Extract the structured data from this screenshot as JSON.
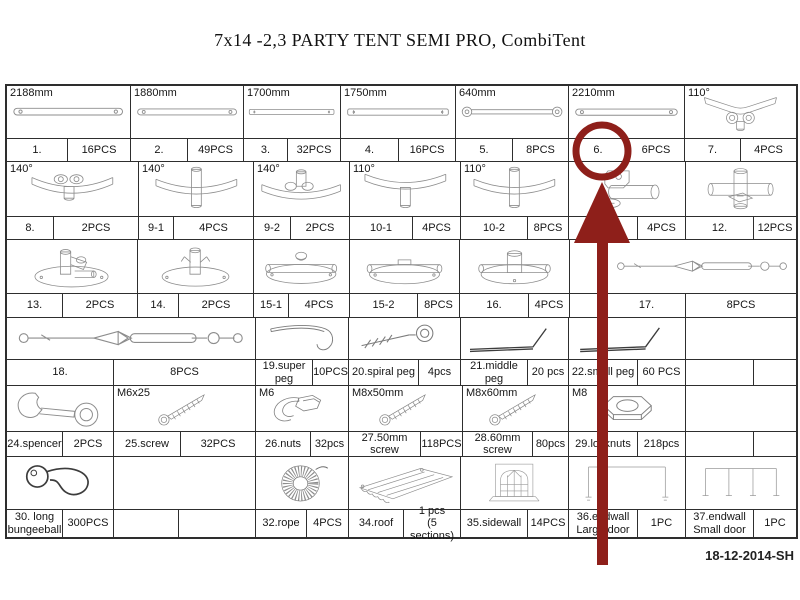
{
  "title": "7x14 -2,3 PARTY TENT SEMI PRO, CombiTent",
  "date_code": "18-12-2014-SH",
  "annotation": {
    "color": "#8e1f1a",
    "circled_part": "6.",
    "shape": "circle-around-part-6-with-arrow-from-below"
  },
  "table": {
    "groups": [
      {
        "illus_h": 53,
        "label_h": 23,
        "cells": [
          {
            "caption": "2188mm",
            "icon": "pole-icon",
            "part": "1.",
            "qty": "16PCS",
            "w": 124,
            "lw": 61
          },
          {
            "caption": "1880mm",
            "icon": "pole-icon",
            "part": "2.",
            "qty": "49PCS",
            "w": 113,
            "lw": 57
          },
          {
            "caption": "1700mm",
            "icon": "pole-flat-icon",
            "part": "3.",
            "qty": "32PCS",
            "w": 97,
            "lw": 44
          },
          {
            "caption": "1750mm",
            "icon": "pole-flat-icon",
            "part": "4.",
            "qty": "16PCS",
            "w": 115,
            "lw": 58
          },
          {
            "caption": "640mm",
            "icon": "strut-icon",
            "part": "5.",
            "qty": "8PCS",
            "w": 113,
            "lw": 57
          },
          {
            "caption": "2210mm",
            "icon": "pole-icon",
            "part": "6.",
            "qty": "6PCS",
            "w": 116,
            "lw": 59
          },
          {
            "caption": "110°",
            "icon": "corner-y-icon",
            "part": "7.",
            "qty": "4PCS",
            "w": 111,
            "lw": 56
          }
        ]
      },
      {
        "illus_h": 55,
        "label_h": 23,
        "cells": [
          {
            "caption": "140°",
            "icon": "corner-knobs-icon",
            "part": "8.",
            "qty": "2PCS",
            "w": 132,
            "lw": 47
          },
          {
            "caption": "140°",
            "icon": "corner-through-icon",
            "part": "9-1",
            "qty": "4PCS",
            "w": 115,
            "lw": 35
          },
          {
            "caption": "140°",
            "icon": "corner-up-icon",
            "part": "9-2",
            "qty": "2PCS",
            "w": 96,
            "lw": 37
          },
          {
            "caption": "110°",
            "icon": "corner-down-icon",
            "part": "10-1",
            "qty": "4PCS",
            "w": 111,
            "lw": 63
          },
          {
            "caption": "110°",
            "icon": "corner-through-icon",
            "part": "10-2",
            "qty": "8PCS",
            "w": 108,
            "lw": 67
          },
          {
            "icon": "tee-connector-icon",
            "part": "11.",
            "qty": "4PCS",
            "w": 117,
            "lw": 69
          },
          {
            "icon": "cross-connector-icon",
            "part": "12.",
            "qty": "12PCS",
            "w": 110,
            "lw": 68
          }
        ]
      },
      {
        "illus_h": 54,
        "label_h": 24,
        "cells": [
          {
            "icon": "base-upright-icon",
            "part": "13.",
            "qty": "2PCS",
            "w": 131,
            "lw": 56
          },
          {
            "icon": "base-fork-icon",
            "part": "14.",
            "qty": "2PCS",
            "w": 116,
            "lw": 41
          },
          {
            "icon": "base-side-icon",
            "part": "15-1",
            "qty": "4PCS",
            "w": 96,
            "lw": 35
          },
          {
            "icon": "base-pipe-icon",
            "part": "15-2",
            "qty": "8PCS",
            "w": 110,
            "lw": 68
          },
          {
            "icon": "base-hub-icon",
            "part": "16.",
            "qty": "4PCS",
            "w": 110,
            "lw": 69
          },
          {
            "spacer": true,
            "w": 38
          },
          {
            "icon": "turnbuckle-icon",
            "part": "17.",
            "qty": "8PCS",
            "w": 188,
            "lw": 78
          }
        ]
      },
      {
        "illus_h": 42,
        "label_h": 26,
        "cells": [
          {
            "icon": "turnbuckle-icon",
            "part": "18.",
            "qty": "8PCS",
            "w": 249,
            "lw": 107
          },
          {
            "icon": "hook-peg-icon",
            "part": "19.super peg",
            "qty": "10PCS",
            "w": 93,
            "lw": 57
          },
          {
            "icon": "spiral-peg-icon",
            "part": "20.spiral peg",
            "qty": "4pcs",
            "w": 112,
            "lw": 70
          },
          {
            "icon": "line-peg-icon",
            "part": "21.middle peg",
            "qty": "20 pcs",
            "w": 108,
            "lw": 67
          },
          {
            "icon": "line-peg-icon",
            "part": "22.small peg",
            "qty": "60 PCS",
            "w": 117,
            "lw": 69
          },
          {
            "part": "",
            "qty": "",
            "w": 110,
            "lw": 68
          }
        ]
      },
      {
        "illus_h": 46,
        "label_h": 25,
        "cells": [
          {
            "icon": "wrench-icon",
            "part": "24.spencer",
            "qty": "2PCS",
            "w": 107,
            "lw": 56
          },
          {
            "caption": "M6x25",
            "icon": "screw-icon",
            "part": "25.screw",
            "qty": "32PCS",
            "w": 142,
            "lw": 67
          },
          {
            "caption": "M6",
            "icon": "clip-nut-icon",
            "part": "26.nuts",
            "qty": "32pcs",
            "w": 93,
            "lw": 55
          },
          {
            "caption": "M8x50mm",
            "icon": "screw-icon",
            "part": "27.50mm screw",
            "qty": "118PCS",
            "w": 114,
            "lw": 72
          },
          {
            "caption": "M8x60mm",
            "icon": "screw-icon",
            "part": "28.60mm screw",
            "qty": "80pcs",
            "w": 106,
            "lw": 70
          },
          {
            "caption": "M8",
            "icon": "locknut-icon",
            "part": "29.locknuts",
            "qty": "218pcs",
            "w": 117,
            "lw": 69
          },
          {
            "part": "",
            "qty": "",
            "w": 110,
            "lw": 68
          }
        ]
      },
      {
        "illus_h": 53,
        "label_h": 27,
        "cells": [
          {
            "icon": "bungee-ball-icon",
            "part": "30. long\nbungeeball",
            "qty": "300PCS",
            "w": 107,
            "lw": 56
          },
          {
            "part": "",
            "qty": "",
            "w": 142,
            "lw": 65
          },
          {
            "icon": "rope-coil-icon",
            "part": "32.rope",
            "qty": "4PCS",
            "w": 93,
            "lw": 51
          },
          {
            "icon": "roof-icon",
            "part": "34.roof",
            "qty": "1 pcs\n(5 sections)",
            "w": 112,
            "lw": 55
          },
          {
            "icon": "sidewall-icon",
            "part": "35.sidewall",
            "qty": "14PCS",
            "w": 108,
            "lw": 67
          },
          {
            "icon": "endwall-large-icon",
            "part": "36.endwall\nLarge door",
            "qty": "1PC",
            "w": 117,
            "lw": 69
          },
          {
            "icon": "endwall-small-icon",
            "part": "37.endwall\nSmall door",
            "qty": "1PC",
            "w": 110,
            "lw": 68
          }
        ]
      }
    ]
  }
}
